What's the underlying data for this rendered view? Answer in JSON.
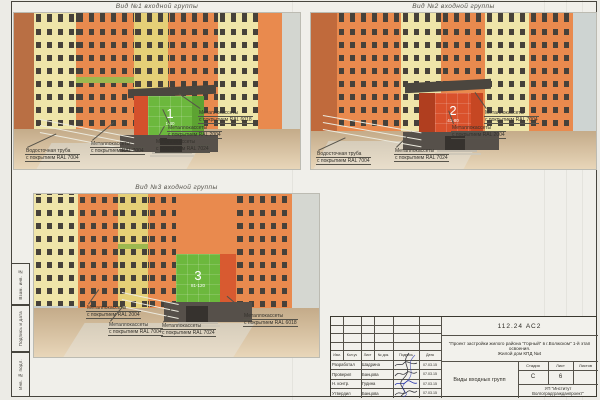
{
  "sheet": {
    "side_labels": [
      "Взам. инв. №",
      "Подпись и дата",
      "Инв. № подл."
    ]
  },
  "views": [
    {
      "title": "Вид №1 входной группы",
      "entrance_number": "1",
      "apartments": "1-40",
      "labels": [
        {
          "line1": "Металлокассеты",
          "line2": "с покрытием RAL 6018"
        },
        {
          "line1": "Металлокассеты",
          "line2": "с покрытием RAL 2004"
        },
        {
          "line1": "Металлокассеты",
          "line2": "с покрытием RAL 7024"
        },
        {
          "line1": "Металлокассеты",
          "line2": "с покрытием RAL 7004"
        },
        {
          "line1": "Водосточная труба",
          "line2": "с покрытием RAL 7004"
        }
      ]
    },
    {
      "title": "Вид №2 входной группы",
      "entrance_number": "2",
      "apartments": "41-80",
      "labels": [
        {
          "line1": "Металлокассеты",
          "line2": "с покрытием RAL 7004"
        },
        {
          "line1": "Металлокассеты",
          "line2": "с покрытием RAL 2004"
        },
        {
          "line1": "Металлокассеты",
          "line2": "с покрытием RAL 7024"
        },
        {
          "line1": "Водосточная труба",
          "line2": "с покрытием RAL 7004"
        }
      ]
    },
    {
      "title": "Вид №3 входной группы",
      "entrance_number": "3",
      "apartments": "81-120",
      "labels": [
        {
          "line1": "Металлокассеты",
          "line2": "с покрытием RAL 2004"
        },
        {
          "line1": "Металлокассеты",
          "line2": "с покрытием RAL 7004"
        },
        {
          "line1": "Металлокассеты",
          "line2": "с покрытием RAL 7024"
        },
        {
          "line1": "Металлокассеты",
          "line2": "с покрытием RAL 6018"
        }
      ]
    }
  ],
  "titleblock": {
    "doc_number": "112.24 АС2",
    "project_line1": "\"Проект застройки жилого района \"Горный\" в г.Волжском\" 1-й этап освоения.",
    "project_line2": "Жилой дом КПД №4",
    "columns": {
      "izm": "Изм.",
      "koluch": "Кол.уч",
      "list": "Лист",
      "ndok": "№ док.",
      "podpis": "Подпись",
      "data": "Дата"
    },
    "rows": [
      {
        "role": "Разработал",
        "name": "Шадрина",
        "date": "07.03.15"
      },
      {
        "role": "Проверил",
        "name": "Банцова",
        "date": "07.03.15"
      },
      {
        "role": "Н. контр.",
        "name": "Гудина",
        "date": "07.03.15"
      },
      {
        "role": "Утвердил",
        "name": "Банцова",
        "date": "07.03.15"
      }
    ],
    "stage_label": "Стадия",
    "sheet_label": "Лист",
    "sheets_label": "Листов",
    "stage": "С",
    "sheet_no": "6",
    "sheets_total": "",
    "drawing_name": "Виды входных групп",
    "org_line1": "УП \"Институт",
    "org_line2": "Волгоградгражданпроект\""
  },
  "colors": {
    "ral_2004_orange": "#e2581f",
    "ral_6018_green": "#6cb83d",
    "ral_7004_grey": "#9d9a94",
    "ral_7024_graphite": "#474b50",
    "facade_orange": "#e98a4e",
    "facade_cream": "#efe5a9",
    "facade_yellow": "#e5d077",
    "ground_beige": "#d9bd9c",
    "paper": "#f0efea"
  }
}
